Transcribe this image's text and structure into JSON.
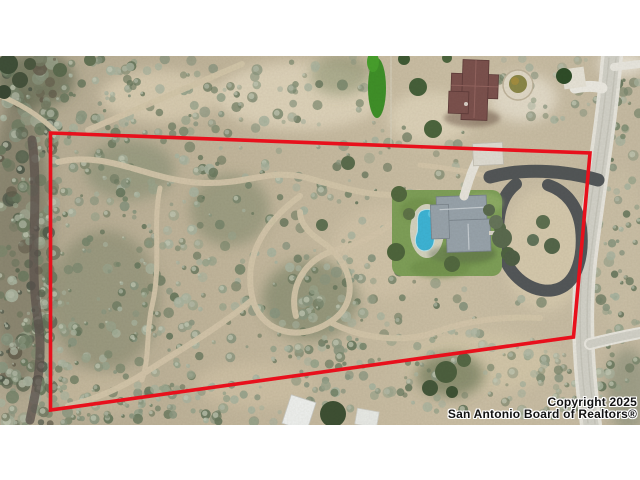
{
  "window": {
    "width": 640,
    "height": 480,
    "kind": "mls-listing-aerial-photo"
  },
  "watermark": {
    "line1": "Copyright 2025",
    "line2": "San Antonio Board of Realtors®"
  },
  "overlay": {
    "name": "property-boundary",
    "shape": "quadrilateral",
    "corners_px": [
      [
        50,
        133
      ],
      [
        590,
        153
      ],
      [
        573,
        337
      ],
      [
        50,
        410
      ]
    ]
  },
  "scene": {
    "type": "aerial-drone-view",
    "features": [
      "scrub-brushland",
      "winding-dirt-trails",
      "dense-trees-left",
      "paved-road-right",
      "main-house-gray-roof",
      "swimming-pool",
      "green-lawn",
      "asphalt-loop-driveway",
      "neighbor-house-brown-roof",
      "circular-garden-bed",
      "shed-roofs-bottom",
      "bright-green-strip-top"
    ],
    "colors": {
      "boundary_red": "#e8101c",
      "letterbox": "#ffffff",
      "dirt_base": "#c6b89f",
      "dirt_light": "#ddd3bc",
      "scrub_green": "#8a9680",
      "scrub_dark": "#5c6752",
      "road_gray": "#d2d1c8",
      "road_shoulder": "#e9e7df",
      "asphalt": "#4c5154",
      "lawn_green": "#7e9f58",
      "pool_blue": "#3db4d6",
      "roof_main_gray": "#98a3ab",
      "roof_neighbor_brown": "#7b514d",
      "watermark_text": "#111111"
    }
  }
}
